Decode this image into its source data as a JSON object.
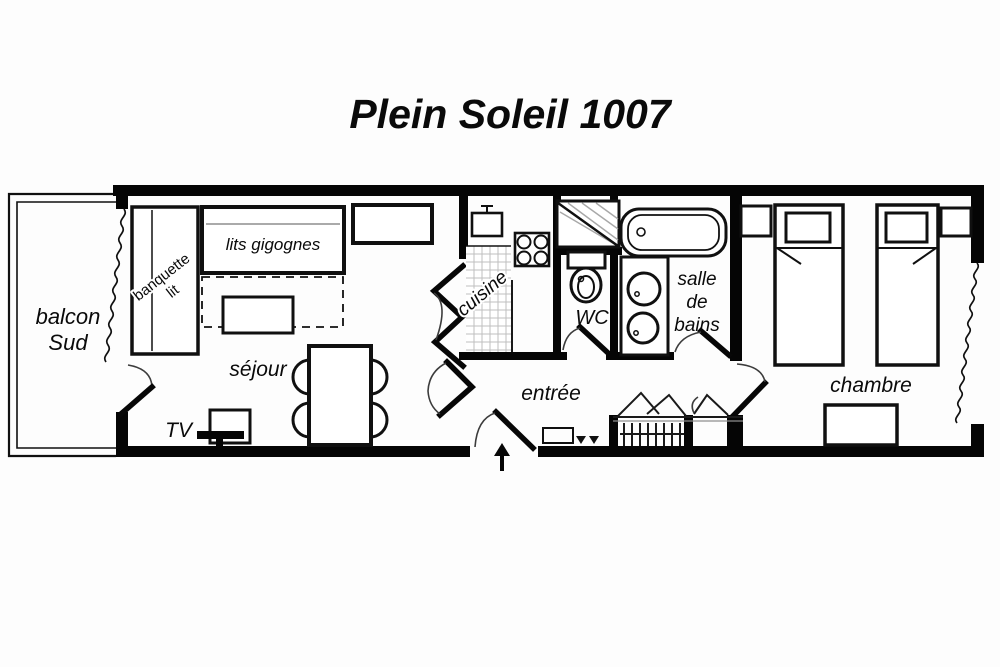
{
  "title": "Plein Soleil 1007",
  "rooms": {
    "balcony_line1": "balcon",
    "balcony_line2": "Sud",
    "living": "séjour",
    "kitchen": "cuisine",
    "entry": "entrée",
    "wc": "WC",
    "bathroom_line1": "salle",
    "bathroom_line2": "de",
    "bathroom_line3": "bains",
    "bedroom": "chambre"
  },
  "furniture": {
    "bench_bed_line1": "banquette",
    "bench_bed_line2": "lit",
    "nested_beds": "lits gigognes",
    "tv": "TV"
  },
  "colors": {
    "walls": "#050505",
    "background": "#ffffff",
    "labels": "#0a0a0a",
    "kitchen_grid": "#bfbfbf",
    "hatch_lines": "#a8a8a8"
  }
}
